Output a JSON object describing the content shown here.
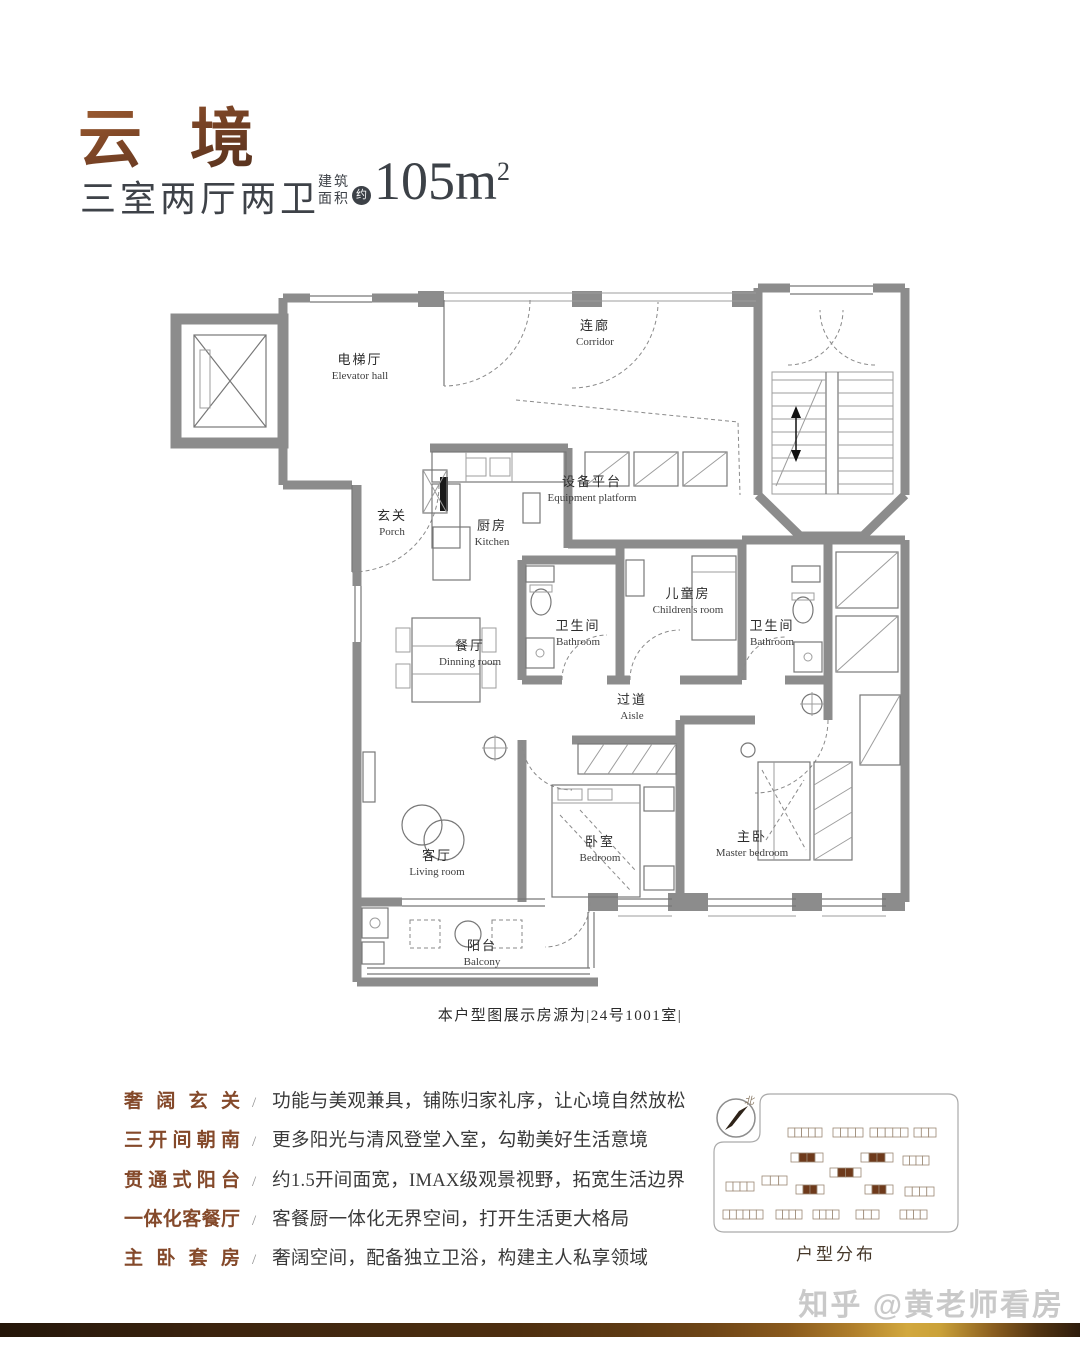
{
  "header": {
    "title": "云 境",
    "layout": "三室两厅两卫",
    "area_label_top": "建筑",
    "area_label_bottom": "面积",
    "area_approx": "约",
    "area_value": "105m",
    "area_exponent": "2"
  },
  "floorplan": {
    "caption": "本户型图展示房源为|24号1001室|",
    "rooms": {
      "elevator_hall": {
        "cn": "电梯厅",
        "en": "Elevator hall"
      },
      "corridor": {
        "cn": "连廊",
        "en": "Corridor"
      },
      "equipment_platform": {
        "cn": "设备平台",
        "en": "Equipment platform"
      },
      "porch": {
        "cn": "玄关",
        "en": "Porch"
      },
      "kitchen": {
        "cn": "厨房",
        "en": "Kitchen"
      },
      "children_room": {
        "cn": "儿童房",
        "en": "Children's room"
      },
      "bathroom1": {
        "cn": "卫生间",
        "en": "Bathroom"
      },
      "bathroom2": {
        "cn": "卫生间",
        "en": "Bathroom"
      },
      "dining_room": {
        "cn": "餐厅",
        "en": "Dinning room"
      },
      "aisle": {
        "cn": "过道",
        "en": "Aisle"
      },
      "living_room": {
        "cn": "客厅",
        "en": "Living room"
      },
      "bedroom": {
        "cn": "卧室",
        "en": "Bedroom"
      },
      "master_bedroom": {
        "cn": "主卧",
        "en": "Master bedroom"
      },
      "balcony": {
        "cn": "阳台",
        "en": "Balcony"
      }
    }
  },
  "features_sep": "/",
  "features": [
    {
      "label": "奢阔玄关",
      "desc": "功能与美观兼具，铺陈归家礼序，让心境自然放松"
    },
    {
      "label": "三开间朝南",
      "desc": "更多阳光与清风登堂入室，勾勒美好生活意境"
    },
    {
      "label": "贯通式阳台",
      "desc": "约1.5开间面宽，IMAX级观景视野，拓宽生活边界"
    },
    {
      "label": "一体化客餐厅",
      "desc": "客餐厨一体化无界空间，打开生活更大格局"
    },
    {
      "label": "主卧套房",
      "desc": "奢阔空间，配备独立卫浴，构建主人私享领域"
    }
  ],
  "siteplan": {
    "label": "户型分布",
    "compass": "北"
  },
  "watermark": "知乎 @黄老师看房",
  "colors": {
    "accent_brown": "#84492a",
    "wall_gray": "#8c8c8c",
    "highlight_building": "#6e3a1b",
    "gold": "#d2a83e"
  }
}
